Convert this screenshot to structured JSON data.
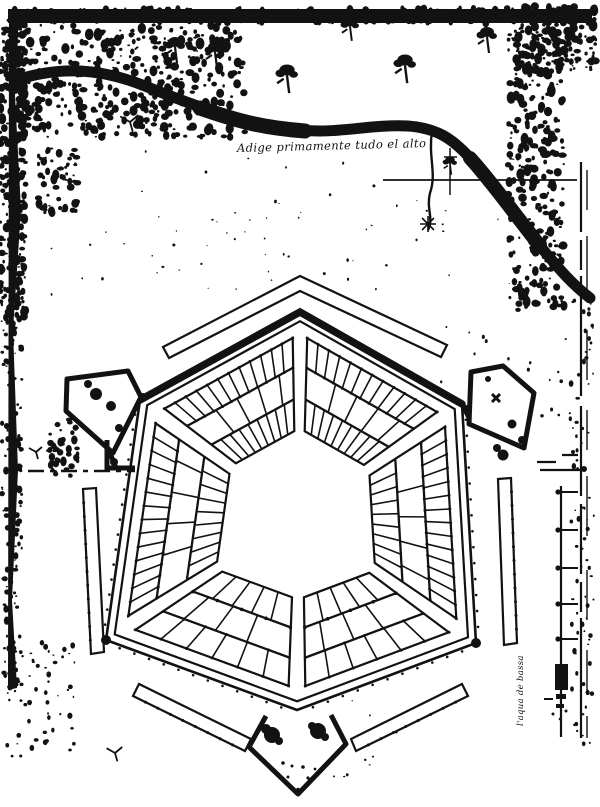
{
  "page": {
    "background": "#ffffff",
    "ink": "#121212"
  },
  "labels": {
    "river_annotation": "Adige primamente tudo el alto",
    "water_note": "l'aqua de bassa"
  },
  "map": {
    "kind": "engraved plan of a hexagonal fortified city beside a river",
    "features": [
      "meandering-river",
      "riverside-trees",
      "hexagonal-rampart",
      "six-city-block-sectors",
      "central-plaza",
      "corner-bastions",
      "detached-outer-ramparts",
      "graphic-scale-bar",
      "inked-border"
    ]
  }
}
